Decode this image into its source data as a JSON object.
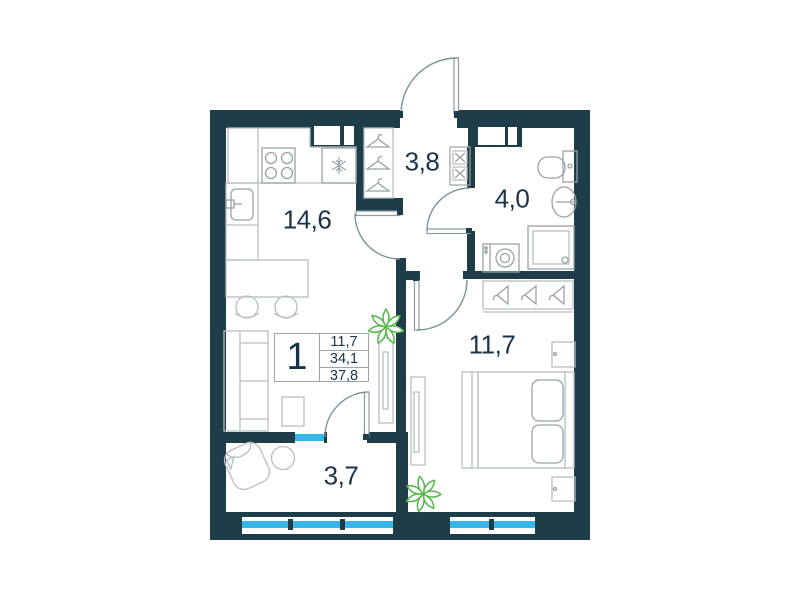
{
  "unit": {
    "number": "1",
    "area_living": "11,7",
    "area_apartment": "34,1",
    "area_total": "37,8"
  },
  "rooms": {
    "kitchen_living": {
      "label": "14,6"
    },
    "hallway": {
      "label": "3,8"
    },
    "bathroom": {
      "label": "4,0"
    },
    "bedroom": {
      "label": "11,7"
    },
    "balcony": {
      "label": "3,7"
    }
  },
  "colors": {
    "wall": "#1e3d49",
    "window": "#36b7e9",
    "plant": "#55b849",
    "furniture_light": "#b7bec2",
    "furniture_mid": "#97a2a7",
    "door_arc": "#7e9198",
    "text": "#1c3347"
  },
  "icons": [
    "stove-icon",
    "snowflake-icon",
    "sink-icon",
    "hanger-icon",
    "toilet-icon",
    "shower-icon",
    "washing-machine-icon",
    "plant-icon",
    "window-sill",
    "door-arc"
  ]
}
